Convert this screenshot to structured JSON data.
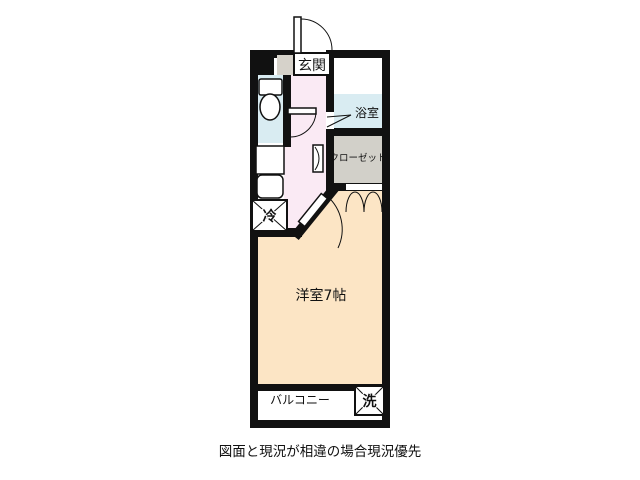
{
  "floorplan": {
    "labels": {
      "entrance": "玄関",
      "bath": "浴室",
      "closet": "クローゼット",
      "main_room": "洋室7帖",
      "balcony": "バルコニー",
      "refrigerator": "冷",
      "washer": "洗"
    },
    "colors": {
      "wall": "#111111",
      "main_room_floor": "#fce5c5",
      "hallway_floor": "#faeaf4",
      "wet_area_floor": "#d9ecf2",
      "closet_floor": "#d2d0c9",
      "service_gray": "#d6d2ca",
      "fixture_white": "#ffffff"
    },
    "caption": "図面と現況が相違の場合現況優先"
  }
}
